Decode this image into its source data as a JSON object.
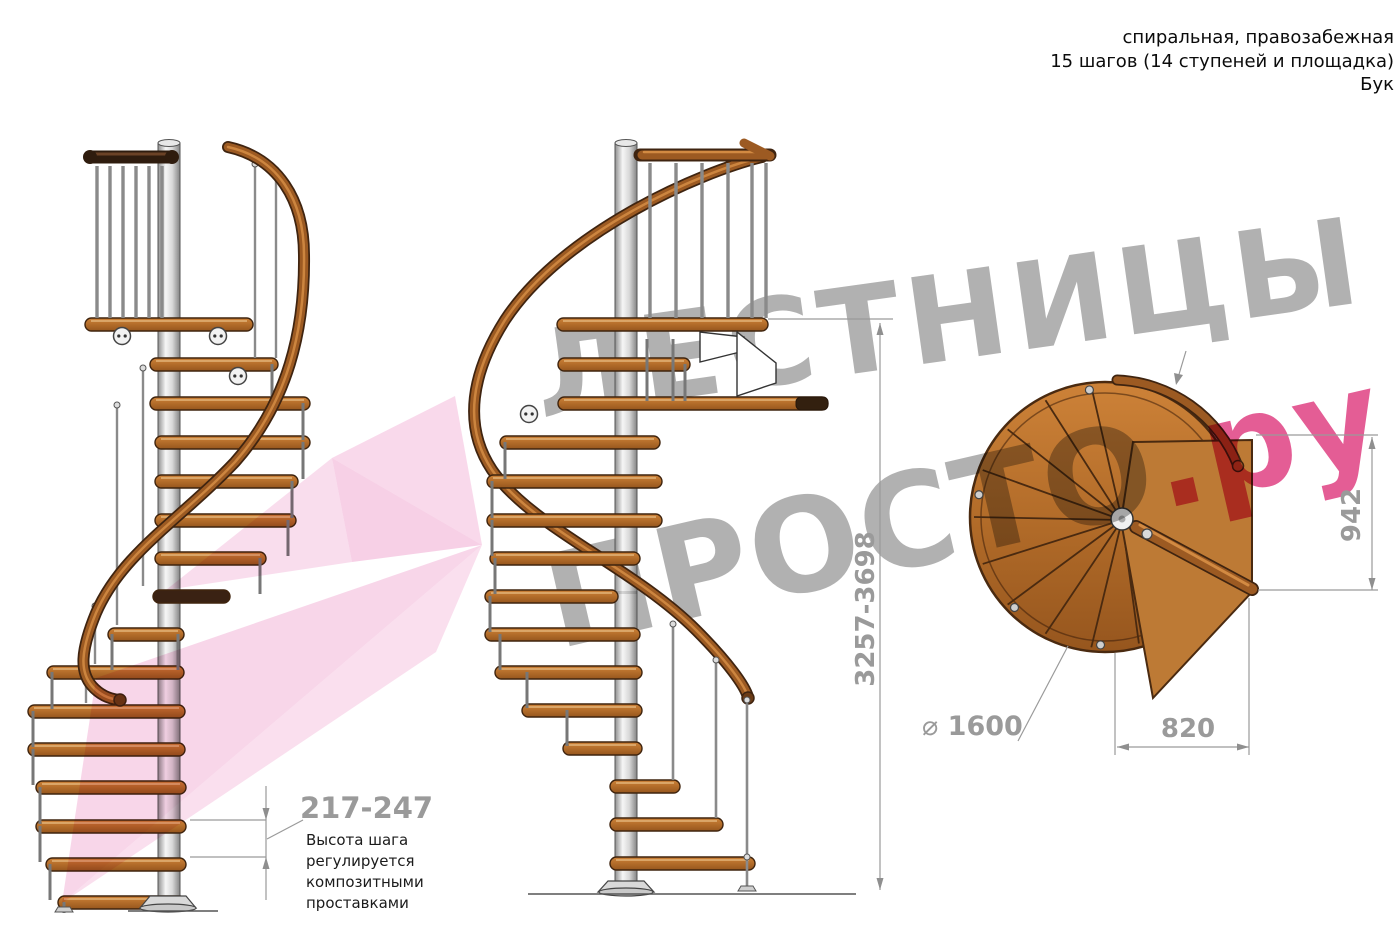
{
  "header": {
    "line1": "спиральная, правозабежная",
    "line2": "15 шагов (14 ступеней и площадка)",
    "line3": "Бук"
  },
  "watermark": {
    "brand_top": "ЛЕСТНИЦЫ",
    "brand_bottom": "ПРОСТО",
    "brand_suffix": ".ру",
    "gray_color": "#9e9e9e",
    "pink_color": "#dd347b",
    "arrow_color": "#f0a5d0"
  },
  "dimensions": {
    "total_height": "3257-3698",
    "landing_length": "942",
    "landing_width": "820",
    "diameter_symbol": "⌀",
    "diameter": "1600",
    "step_height": "217-247",
    "step_note_lines": [
      "Высота шага",
      "регулируется",
      "композитными",
      "проставками"
    ]
  },
  "colors": {
    "wood": "#b5712f",
    "wood_dark": "#3f240e",
    "rail": "#9c5a22",
    "metal": "#c9c9c9",
    "dim_line": "#9a9a9a",
    "note_text": "#1b1b1b"
  }
}
